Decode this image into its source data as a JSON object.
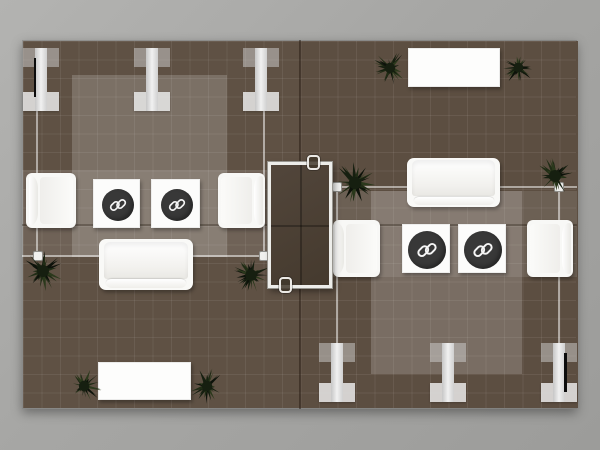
{
  "meta": {
    "description": "Top-down rendered floor plan of a two-bay trade show exhibit booth with lounge seating, branded side tables, plants and truss legs",
    "visible_text": "",
    "brand_mark": "interlocking rounded-square logo on dark circular table tops"
  },
  "palette": {
    "surround_gray_1": "#b3b3b1",
    "surround_gray_2": "#9c9c9a",
    "floor_left": "#5f5144",
    "floor_right": "#5c4e41",
    "rug_overlay": "#ffffff",
    "frame_line": "rgba(255,255,255,0.5)",
    "beam_gray": "#e8e8e8",
    "furniture_white": "#f9f9f7",
    "logo_circle": "#383838",
    "logo_mark": "#f5f5f5",
    "center_table_top": "#4b4034",
    "plant_greens": [
      "#0d120a",
      "#161f10",
      "#202c15",
      "#2b391c"
    ]
  },
  "floor": {
    "x": 22,
    "y": 40,
    "w": 555,
    "h": 369,
    "left_half_w": 278
  },
  "dividers": [
    {
      "name": "bay-divider-vertical",
      "x": 299,
      "y": 40,
      "w": 2,
      "h": 369,
      "c": "rgba(30,20,10,0.45)"
    },
    {
      "name": "bay-divider-horizontal",
      "x": 22,
      "y": 224,
      "w": 555,
      "h": 1.5,
      "c": "rgba(30,20,10,0.30)"
    }
  ],
  "overlays": [
    {
      "name": "left-rug",
      "x": 72,
      "y": 75,
      "w": 155,
      "h": 182,
      "o": 0.18
    },
    {
      "name": "left-band",
      "x": 22,
      "y": 170,
      "w": 278,
      "h": 87,
      "o": 0.1
    },
    {
      "name": "right-rug",
      "x": 371,
      "y": 191,
      "w": 151,
      "h": 183,
      "o": 0.18
    },
    {
      "name": "right-band",
      "x": 300,
      "y": 191,
      "w": 277,
      "h": 86,
      "o": 0.1
    }
  ],
  "frame_lines": [
    {
      "x": 36,
      "y": 106,
      "w": 2,
      "h": 150
    },
    {
      "x": 263,
      "y": 106,
      "w": 2,
      "h": 150
    },
    {
      "x": 22,
      "y": 255,
      "w": 278,
      "h": 2
    },
    {
      "x": 336,
      "y": 188,
      "w": 2,
      "h": 156
    },
    {
      "x": 558,
      "y": 188,
      "w": 2,
      "h": 156
    },
    {
      "x": 300,
      "y": 186,
      "w": 277,
      "h": 2
    }
  ],
  "posts": [
    {
      "x": 33,
      "y": 251
    },
    {
      "x": 259,
      "y": 251
    },
    {
      "x": 332,
      "y": 182
    },
    {
      "x": 554,
      "y": 182
    }
  ],
  "post_size": 10,
  "beams": {
    "w": 36,
    "cap_h": 19,
    "stem_w": 12,
    "items": [
      {
        "name": "truss-leg-1",
        "x": 23,
        "y": 48,
        "h": 63,
        "accent": "left"
      },
      {
        "name": "truss-leg-2",
        "x": 134,
        "y": 48,
        "h": 63,
        "accent": null
      },
      {
        "name": "truss-leg-3",
        "x": 243,
        "y": 48,
        "h": 63,
        "accent": null
      },
      {
        "name": "truss-leg-4",
        "x": 319,
        "y": 343,
        "h": 59,
        "accent": null
      },
      {
        "name": "truss-leg-5",
        "x": 430,
        "y": 343,
        "h": 59,
        "accent": null
      },
      {
        "name": "truss-leg-6",
        "x": 541,
        "y": 343,
        "h": 59,
        "accent": "right"
      }
    ]
  },
  "furniture": [
    {
      "type": "armchair",
      "name": "armchair-1",
      "x": 26,
      "y": 173,
      "w": 50,
      "h": 55,
      "facing": "right"
    },
    {
      "type": "logo-table",
      "name": "logo-side-table-1",
      "x": 93,
      "y": 179,
      "w": 47,
      "h": 49,
      "r": 16
    },
    {
      "type": "logo-table",
      "name": "logo-side-table-2",
      "x": 151,
      "y": 179,
      "w": 49,
      "h": 49,
      "r": 16
    },
    {
      "type": "armchair",
      "name": "armchair-2",
      "x": 218,
      "y": 173,
      "w": 47,
      "h": 55,
      "facing": "left"
    },
    {
      "type": "sofa",
      "name": "sofa-1",
      "x": 99,
      "y": 239,
      "w": 94,
      "h": 51
    },
    {
      "type": "table",
      "name": "coffee-table-1",
      "x": 98,
      "y": 362,
      "w": 93,
      "h": 38
    },
    {
      "type": "table",
      "name": "console-table-2",
      "x": 408,
      "y": 48,
      "w": 92,
      "h": 39
    },
    {
      "type": "sofa",
      "name": "sofa-2",
      "x": 407,
      "y": 158,
      "w": 93,
      "h": 49
    },
    {
      "type": "armchair",
      "name": "armchair-3",
      "x": 333,
      "y": 220,
      "w": 47,
      "h": 57,
      "facing": "right"
    },
    {
      "type": "logo-table",
      "name": "logo-side-table-3",
      "x": 402,
      "y": 224,
      "w": 48,
      "h": 49,
      "r": 19
    },
    {
      "type": "logo-table",
      "name": "logo-side-table-4",
      "x": 458,
      "y": 224,
      "w": 48,
      "h": 49,
      "r": 19
    },
    {
      "type": "armchair",
      "name": "armchair-4",
      "x": 527,
      "y": 220,
      "w": 46,
      "h": 57,
      "facing": "left"
    }
  ],
  "plants": [
    {
      "x": 43,
      "y": 271,
      "s": 46,
      "seed": 3
    },
    {
      "x": 251,
      "y": 275,
      "s": 44,
      "seed": 10
    },
    {
      "x": 84,
      "y": 386,
      "s": 40,
      "seed": 17
    },
    {
      "x": 207,
      "y": 386,
      "s": 40,
      "seed": 24
    },
    {
      "x": 390,
      "y": 68,
      "s": 40,
      "seed": 31
    },
    {
      "x": 518,
      "y": 67,
      "s": 37,
      "seed": 38
    },
    {
      "x": 355,
      "y": 183,
      "s": 48,
      "seed": 45
    },
    {
      "x": 555,
      "y": 176,
      "s": 46,
      "seed": 52
    }
  ],
  "center_table": {
    "x": 268,
    "y": 162,
    "w": 64,
    "h": 126,
    "handles": [
      {
        "x": 307,
        "y": 155,
        "w": 13,
        "h": 15
      },
      {
        "x": 279,
        "y": 277,
        "w": 13,
        "h": 16
      }
    ]
  }
}
